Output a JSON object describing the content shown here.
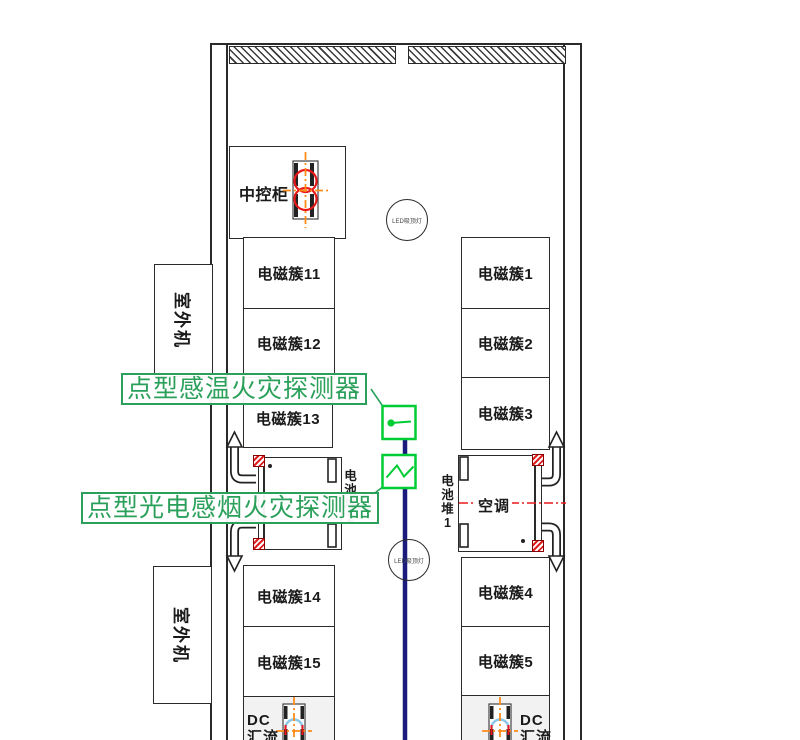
{
  "diagram_title": "储能集装箱消防平面布置图",
  "labels": {
    "control_cabinet": "中控柜",
    "outdoor_unit": "室外机",
    "air_conditioner": "空调",
    "battery_stack_left": "电池堆2",
    "battery_stack_right": "电池堆1",
    "led_light": "LED吸顶灯",
    "heat_detector": "点型感温火灾探测器",
    "smoke_detector": "点型光电感烟火灾探测器",
    "dc_line1": "DC",
    "dc_line2": "汇流"
  },
  "cabinets": {
    "left": [
      "电磁簇11",
      "电磁簇12",
      "电磁簇13",
      "电磁簇14",
      "电磁簇15"
    ],
    "right": [
      "电磁簇1",
      "电磁簇2",
      "电磁簇3",
      "电磁簇4",
      "电磁簇5"
    ]
  },
  "colors": {
    "detector_green": "#00cc33",
    "label_green": "#2aa05a",
    "signal_line_navy": "#1b1b7e",
    "alarm_red": "#e81818",
    "axis_orange": "#ff8c1a",
    "arc_blue": "#8cc8e8",
    "wall_black": "#2a2a2a"
  }
}
